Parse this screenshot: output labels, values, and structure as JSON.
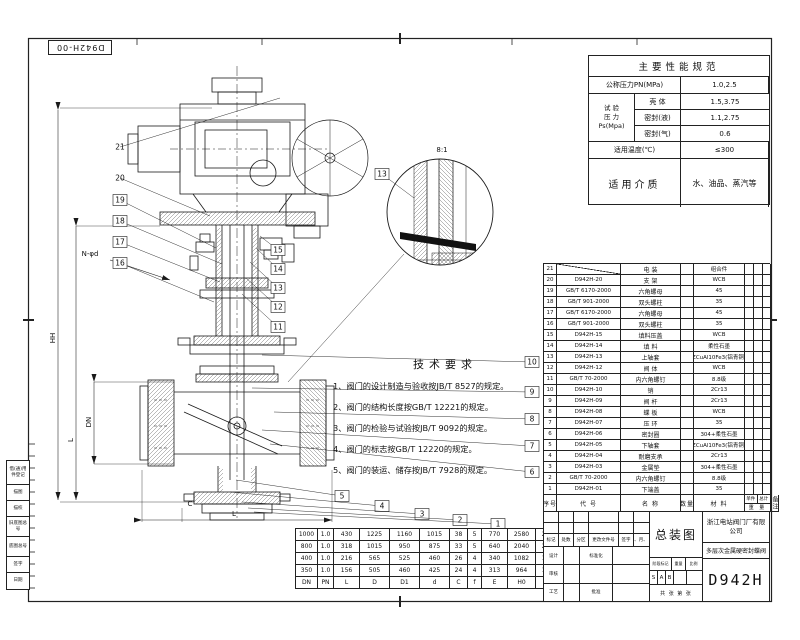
{
  "colors": {
    "line": "#1a1a1a",
    "bg": "#ffffff",
    "hatch": "#666666"
  },
  "sheet": {
    "corner_stamp": "D942H-00"
  },
  "performance": {
    "title": "主要性能规范",
    "nominal_pressure": {
      "label": "公称压力PN(MPa)",
      "value": "1.0,2.5"
    },
    "test_pressure": {
      "label_lines": [
        "试 验",
        "压 力",
        "Ps(Mpa)"
      ],
      "rows": [
        {
          "name": "壳 体",
          "value": "1.5,3.75"
        },
        {
          "name": "密封(液)",
          "value": "1.1,2.75"
        },
        {
          "name": "密封(气)",
          "value": "0.6"
        }
      ]
    },
    "temperature": {
      "label": "适用温度(℃)",
      "value": "≤300"
    },
    "medium": {
      "label": "适用介质",
      "value": "水、油品、蒸汽等"
    }
  },
  "tech_requirements": {
    "title": "技术要求",
    "items": [
      "1、阀门的设计制造与验收按JB/T 8527的规定。",
      "2、阀门的结构长度按GB/T 12221的规定。",
      "3、阀门的检验与试验按JB/T 9092的规定。",
      "4、阀门的标志按GB/T 12220的规定。",
      "5、阀门的装运、储存按JB/T 7928的规定。"
    ]
  },
  "parts_list": {
    "header": {
      "no": "序号",
      "code": "代 号",
      "name": "名 称",
      "qty": "数量",
      "material": "材 料",
      "weight": "重 量",
      "weight_unit": "单件",
      "weight_total": "总计",
      "remark": "备注"
    },
    "rows": [
      {
        "no": "21",
        "code": "",
        "name": "电 装",
        "qty": "",
        "material": "组合件"
      },
      {
        "no": "20",
        "code": "D942H-20",
        "name": "支 架",
        "qty": "",
        "material": "WCB"
      },
      {
        "no": "19",
        "code": "GB/T 6170-2000",
        "name": "六角螺母",
        "qty": "",
        "material": "45"
      },
      {
        "no": "18",
        "code": "GB/T 901-2000",
        "name": "双头螺柱",
        "qty": "",
        "material": "35"
      },
      {
        "no": "17",
        "code": "GB/T 6170-2000",
        "name": "六角螺母",
        "qty": "",
        "material": "45"
      },
      {
        "no": "16",
        "code": "GB/T 901-2000",
        "name": "双头螺柱",
        "qty": "",
        "material": "35"
      },
      {
        "no": "15",
        "code": "D942H-15",
        "name": "填料压盖",
        "qty": "",
        "material": "WCB"
      },
      {
        "no": "14",
        "code": "D942H-14",
        "name": "填 料",
        "qty": "",
        "material": "柔性石墨"
      },
      {
        "no": "13",
        "code": "D942H-13",
        "name": "上轴套",
        "qty": "",
        "material": "ZCuAl10Fe3(铝青铜)"
      },
      {
        "no": "12",
        "code": "D942H-12",
        "name": "阀 体",
        "qty": "",
        "material": "WCB"
      },
      {
        "no": "11",
        "code": "GB/T 70-2000",
        "name": "内六角螺钉",
        "qty": "",
        "material": "8.8级"
      },
      {
        "no": "10",
        "code": "D942H-10",
        "name": "销",
        "qty": "",
        "material": "2Cr13"
      },
      {
        "no": "9",
        "code": "D942H-09",
        "name": "阀 杆",
        "qty": "",
        "material": "2Cr13"
      },
      {
        "no": "8",
        "code": "D942H-08",
        "name": "蝶 板",
        "qty": "",
        "material": "WCB"
      },
      {
        "no": "7",
        "code": "D942H-07",
        "name": "压 环",
        "qty": "",
        "material": "35"
      },
      {
        "no": "6",
        "code": "D942H-06",
        "name": "密封圈",
        "qty": "",
        "material": "304+柔性石墨"
      },
      {
        "no": "5",
        "code": "D942H-05",
        "name": "下轴套",
        "qty": "",
        "material": "ZCuAl10Fe3(铝青铜)"
      },
      {
        "no": "4",
        "code": "D942H-04",
        "name": "耐磨支承",
        "qty": "",
        "material": "2Cr13"
      },
      {
        "no": "3",
        "code": "D942H-03",
        "name": "金属垫",
        "qty": "",
        "material": "304+柔性石墨"
      },
      {
        "no": "2",
        "code": "GB/T 70-2000",
        "name": "内六角螺钉",
        "qty": "",
        "material": "8.8级"
      },
      {
        "no": "1",
        "code": "D942H-01",
        "name": "下端盖",
        "qty": "",
        "material": "35"
      }
    ]
  },
  "dimension_table": {
    "columns": [
      "DN",
      "PN",
      "L",
      "D",
      "D1",
      "d",
      "C",
      "f",
      "E",
      "H0",
      "n-φd"
    ],
    "rows": [
      [
        "1000",
        "1.0",
        "430",
        "1225",
        "1160",
        "1015",
        "38",
        "5",
        "770",
        "2580",
        "28-36"
      ],
      [
        "800",
        "1.0",
        "318",
        "1015",
        "950",
        "875",
        "33",
        "5",
        "640",
        "2040",
        "24-33"
      ],
      [
        "400",
        "1.0",
        "216",
        "565",
        "525",
        "460",
        "26",
        "4",
        "340",
        "1082",
        "16-26"
      ],
      [
        "350",
        "1.0",
        "156",
        "505",
        "460",
        "425",
        "24",
        "4",
        "313",
        "964",
        "16-22"
      ]
    ]
  },
  "title_block": {
    "assembly_title": "总装图",
    "company": "浙江电站阀门厂有限公司",
    "product": "多层次金属硬密封蝶阀",
    "model": "D942H",
    "revision_cols": [
      "标记",
      "处数",
      "分区",
      "更改文件号",
      "签字",
      "年、月、日"
    ],
    "sign_labels": {
      "design": "设计",
      "standard": "标准化",
      "check": "审核",
      "process": "工艺",
      "approve": "批准"
    },
    "stage": {
      "mark": "阶段标记",
      "weight": "重量",
      "scale": "比例",
      "marks": [
        "S",
        "A",
        "B"
      ],
      "sheets": "共 张 第 张"
    }
  },
  "margin_block": {
    "rows": [
      "借(通)用件登记",
      "描图",
      "描校",
      "旧底图总号",
      "底图总号",
      "签字",
      "日期"
    ]
  },
  "drawing": {
    "balloons_left": [
      "21",
      "20",
      "19",
      "18",
      "17",
      "16"
    ],
    "balloons_gland": [
      "15",
      "14",
      "13",
      "12",
      "11"
    ],
    "balloons_right": [
      "10",
      "9",
      "8",
      "7",
      "6"
    ],
    "balloons_bottom": [
      "5",
      "4",
      "3",
      "2",
      "1"
    ],
    "dim_labels": {
      "hh": "HH",
      "l_vert": "L",
      "dn": "DN",
      "l_bottom": "L",
      "c": "C",
      "bolt_holes": "N-φd"
    },
    "detail": {
      "scale": "8:1",
      "balloon": "13"
    }
  }
}
